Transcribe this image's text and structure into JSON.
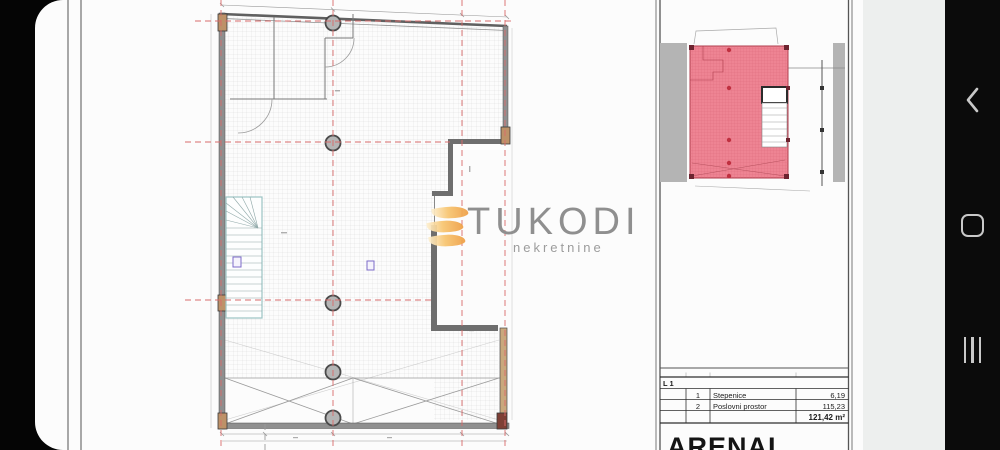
{
  "watermark": {
    "brand": "TUKODI",
    "tagline": "nekretnine",
    "logo_color": "#f0a24a"
  },
  "panel": {
    "level_label": "L 1",
    "rows": [
      {
        "num": "1",
        "name": "Stepenice",
        "area": "6,19"
      },
      {
        "num": "2",
        "name": "Poslovni prostor",
        "area": "115,23"
      }
    ],
    "total_area": "121,42 m²",
    "project_title": "ARENAL"
  },
  "device_nav": {
    "back_icon": "chevron-left",
    "home_icon": "rounded-square",
    "recents_icon": "three-bars"
  },
  "colors": {
    "axis_red": "#d96b6b",
    "plan_fill": "#ee8493",
    "plan_stroke": "#b03e4e",
    "site_gray": "#b4b4b4",
    "accent_orange": "#f0a24a"
  }
}
